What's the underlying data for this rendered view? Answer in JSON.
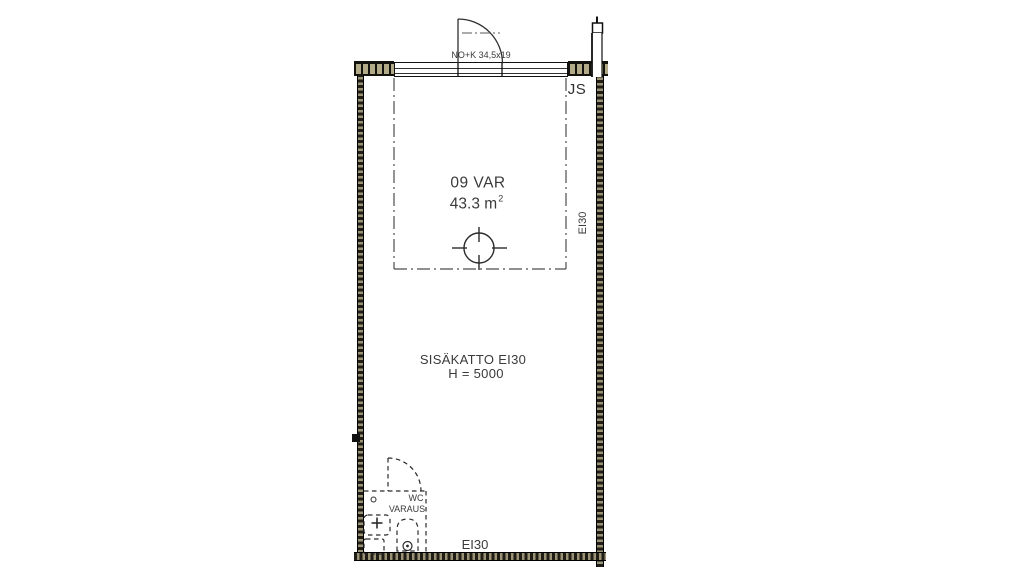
{
  "plan": {
    "room": {
      "id": "09 VAR",
      "area": "43.3 m",
      "area_exponent": "2"
    },
    "ceiling_note": {
      "line1": "SISÄKATTO EI30",
      "line2": "H = 5000"
    },
    "fire_ratings": {
      "right_wall": "EI30",
      "bottom_wall": "EI30"
    },
    "marks": {
      "top_door": "NO+K 34,5x19",
      "junction": "JS"
    },
    "wc_reservation": {
      "line1": "WC",
      "line2": "VARAUS"
    },
    "colors": {
      "wall_hatch_fill": "#b3ab87",
      "wall_dark": "#201d16",
      "line": "#2f2f2f",
      "dash_line": "#4d4d4d",
      "text": "#3a3a3a",
      "background": "#ffffff"
    },
    "symbols": {
      "floor_drain": "circle-with-cross-ticks",
      "downspout": "rain-pipe-with-cap",
      "top_door": "quarter-circle-door-swing",
      "wc_door": "dashed-quarter-circle-door-swing",
      "toilet": "dashed-toilet-seat",
      "sink": "dashed-washbasin-with-tap-cross",
      "cabinet": "dashed-square"
    }
  }
}
